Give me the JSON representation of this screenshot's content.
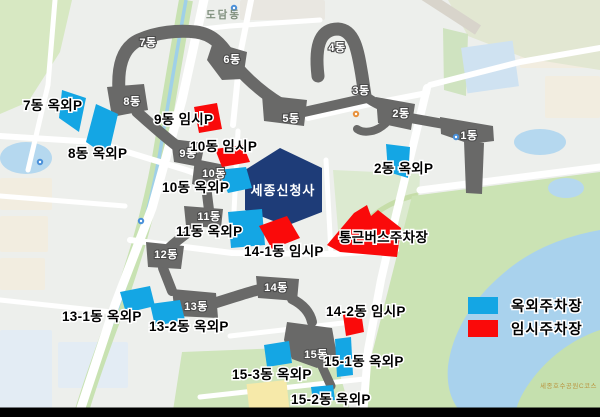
{
  "map": {
    "district_label": "도담동",
    "lake_course_label": "세종호수공원C코스",
    "complex_label": "세종신청사",
    "building_labels": [
      {
        "text": "7동",
        "x": 148,
        "y": 46
      },
      {
        "text": "6동",
        "x": 232,
        "y": 63
      },
      {
        "text": "4동",
        "x": 337,
        "y": 51
      },
      {
        "text": "3동",
        "x": 361,
        "y": 94
      },
      {
        "text": "2동",
        "x": 401,
        "y": 117
      },
      {
        "text": "1동",
        "x": 469,
        "y": 139
      },
      {
        "text": "8동",
        "x": 132,
        "y": 105
      },
      {
        "text": "5동",
        "x": 291,
        "y": 122
      },
      {
        "text": "9동",
        "x": 188,
        "y": 157
      },
      {
        "text": "10동",
        "x": 214,
        "y": 177
      },
      {
        "text": "11동",
        "x": 209,
        "y": 220
      },
      {
        "text": "12동",
        "x": 166,
        "y": 258
      },
      {
        "text": "13동",
        "x": 196,
        "y": 310
      },
      {
        "text": "14동",
        "x": 276,
        "y": 291
      },
      {
        "text": "15동",
        "x": 316,
        "y": 358
      }
    ],
    "parking_labels": [
      {
        "text": "7동 옥외P",
        "x": 23,
        "y": 110
      },
      {
        "text": "8동 옥외P",
        "x": 68,
        "y": 158
      },
      {
        "text": "9동 임시P",
        "x": 154,
        "y": 124
      },
      {
        "text": "10동 임시P",
        "x": 190,
        "y": 151
      },
      {
        "text": "10동 옥외P",
        "x": 162,
        "y": 192
      },
      {
        "text": "11동 옥외P",
        "x": 176,
        "y": 236
      },
      {
        "text": "2동 옥외P",
        "x": 374,
        "y": 173
      },
      {
        "text": "통근버스주차장",
        "x": 339,
        "y": 242
      },
      {
        "text": "14-1동 임시P",
        "x": 244,
        "y": 256
      },
      {
        "text": "13-1동 옥외P",
        "x": 62,
        "y": 321
      },
      {
        "text": "13-2동 옥외P",
        "x": 149,
        "y": 331
      },
      {
        "text": "14-2동 임시P",
        "x": 326,
        "y": 316
      },
      {
        "text": "15-1동 옥외P",
        "x": 324,
        "y": 366
      },
      {
        "text": "15-3동 옥외P",
        "x": 232,
        "y": 379
      },
      {
        "text": "15-2동 옥외P",
        "x": 291,
        "y": 404
      }
    ],
    "legend": {
      "items": [
        {
          "label": "옥외주차장",
          "type": "outdoor"
        },
        {
          "label": "임시주차장",
          "type": "temporary"
        }
      ]
    },
    "colors": {
      "outdoor_parking": "#14a6e4",
      "temporary_parking": "#fa0a0a",
      "government_building": "#696968",
      "new_complex_building": "#1e3c78",
      "lake_water": "#a9d2ed",
      "park_green": "#cfe5bb"
    },
    "icons": {
      "poi": "map-poi-icon"
    }
  }
}
